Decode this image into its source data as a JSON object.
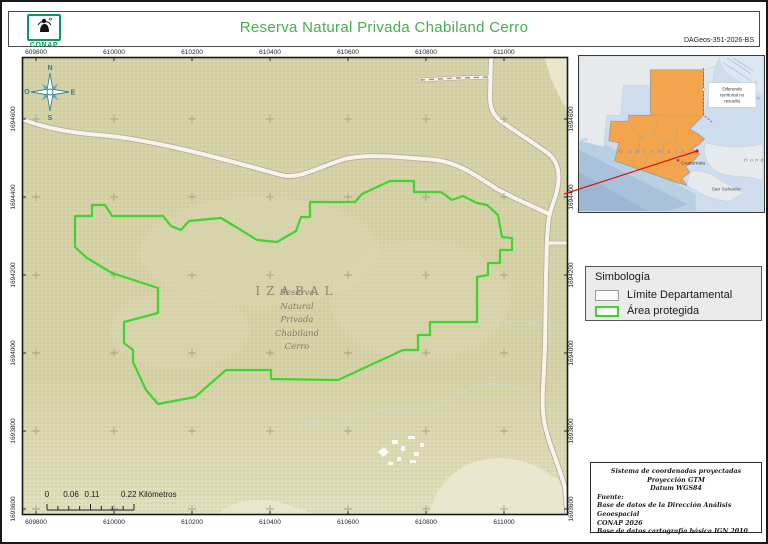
{
  "header": {
    "title": "Reserva Natural Privada Chabiland Cerro",
    "logo_text": "CONAP",
    "doc_code": "DAGeos-351-2026-BS"
  },
  "colors": {
    "title_green": "#44b14b",
    "logo_green": "#0a9a5e",
    "protected_area_green": "#3fd42e",
    "map_background": "#d6d3a8",
    "guatemala_orange": "#f2a54d",
    "sea_blue": "#cddded",
    "road_fill": "#f8f4ec",
    "red_connector": "#de1411",
    "compass_teal": "#35808f"
  },
  "map": {
    "x_labels": [
      "609800",
      "610000",
      "610200",
      "610400",
      "610600",
      "610800",
      "611000"
    ],
    "y_labels": [
      "1694600",
      "1694400",
      "1694200",
      "1694000",
      "1693800",
      "1693600"
    ],
    "x_px": [
      36,
      114,
      192,
      270,
      348,
      426,
      504
    ],
    "y_px": [
      119,
      197,
      275,
      353,
      431,
      509
    ],
    "department_label": "IZABAL",
    "reserve_label_lines": [
      "Reserva",
      "Natural",
      "Privada",
      "Chabiland",
      "Cerro"
    ],
    "compass": {
      "n": "N",
      "e": "E",
      "s": "S",
      "o": "O"
    },
    "geometry": {
      "area_points": "75,216 92,216 92,205 105,205 112,216 163,216 171,226 181,230 189,221 221,218 236,227 257,240 277,242 296,231 301,217 310,217 310,202 355,202 362,194 390,181 414,181 414,192 441,192 452,200 463,196 477,203 487,205 498,215 502,237 512,238 512,250 500,250 500,263 488,263 488,275 477,277 477,322 430,322 430,335 418,335 418,350 403,350 338,380 271,379 271,370 226,370 195,397 158,404 146,390 133,362 133,350 124,343 124,322 158,313 158,288 112,273 87,258 75,247",
      "road_main_d": "M8,113 C30,124 60,132 100,135 C150,139 220,158 281,175 C300,180 320,166 345,159 C370,153 410,158 436,160 C460,163 478,177 497,189 C517,200 533,206 549,214",
      "road_east_d": "M491,57 L490,96 C490,110 494,116 502,122 L545,151 C557,159 560,170 558,185 C556,200 551,205 549,218 C546,235 547,255 546,275 L545,345 C544,380 541,400 544,420 C548,444 559,464 565,488 L567,512",
      "road_stub_d": "M420,80 L458,78 L489,77",
      "road_branch_d": "M549,243 L568,243",
      "streams_d": "M297,428 C320,418 340,424 360,416 C385,406 398,412 420,410 C445,408 452,396 470,388 C490,380 510,384 528,392 M468,300 C485,310 495,325 515,322 C535,319 545,330 560,328",
      "clearings_d": "M430,515 C432,492 452,466 482,460 C516,453 543,468 558,480 C566,492 568,500 568,515 Z M218,515 C230,500 262,496 285,504 C298,509 310,512 318,515 Z M545,57 L568,57 L568,112 C558,95 548,75 545,57 Z",
      "buildings_d": "M378,452 l6,-5 5,5 -6,5 z M392,440 h6 v4 h-6 z M401,446 h4 v5 h-4 z M408,436 h7 v3 h-7 z M414,452 h5 v4 h-5 z M397,457 h4 v4 h-4 z M388,462 h5 v3 h-5 z M420,443 h4 v4 h-4 z M410,460 h6 v3 h-6 z",
      "red_connector_d": "M564,194 L697,151"
    }
  },
  "scalebar": {
    "zero": "0",
    "mid1": "0.06",
    "mid2": "0.11",
    "end": "0.22 Kilómetros"
  },
  "locator": {
    "country_label": "G u a t e m a l a",
    "city_label": "Guatemala",
    "san_salvador_label": "San Salvador",
    "honduras_label": "Honduras",
    "gulf_label_1": "G",
    "gulf_label_2": "Honda",
    "depth_label": "221",
    "note_line1": "Diferendo",
    "note_line2": "territorial no",
    "note_line3": "resuelto",
    "geometry": {
      "mexico_d": "M0,0 L143,0 L138,10 L130,24 L126,14 L72,14 L72,30 L45,30 L42,60 L28,60 L25,92 L0,86 Z",
      "belize_d": "M126,14 L138,10 L134,34 L129,50 L126,60 Z",
      "honduras_d": "M128,88 C145,92 162,94 186,89 L186,126 C165,120 150,124 138,116 C130,110 124,100 128,88 Z",
      "elsalvador_d": "M112,118 C120,114 132,118 140,124 C150,131 158,133 166,139 L152,147 C136,147 120,138 109,131 Z",
      "guatemala_d": "M72,14 L126,14 L126,60 L112,74 L119,78 L127,84 L121,90 L114,94 L122,99 L116,106 L108,112 L112,118 L104,124 L109,131 L98,128 L36,106 L40,88 L30,86 L32,66 L50,66 L50,60 L72,60 Z",
      "dept_borders_d": "M72,60 L125,60 M50,66 L62,82 L60,98 M62,82 L76,78 L80,64 M76,78 L86,88 L84,104 M86,88 L98,84 L100,72 M98,84 L104,95 M58,98 L54,106 M70,100 L66,112 M80,106 L78,116 M92,102 L90,114 M104,95 L100,106",
      "belize_border_d": "M126,12 L126,60 L136,68",
      "pacific_band1_d": "M0,75 L118,140 L118,157 L0,157 Z",
      "pacific_band2_d": "M0,95 L110,150 L90,157 L0,157 Z",
      "pacific_band3_d": "M0,118 L70,157 L0,157 Z",
      "caribbean_d": "M140,0 L186,0 L186,40 L150,18 Z",
      "caribbean_stripes_d": "M150,2 l24,16 M146,7 l28,18 M156,2 l20,13 M128,20 h8 M127,30 h8 M127,40 h7"
    }
  },
  "legend": {
    "title": "Simbología",
    "items": [
      {
        "label": "Límite Departamental"
      },
      {
        "label": "Área protegida"
      }
    ]
  },
  "source_box": {
    "line1": "Sistema de coordenadas proyectadas",
    "line2": "Proyección GTM",
    "line3": "Datum WGS84",
    "line4": "Fuente:",
    "line5": "Base de datos de la Dirección Análisis Geoespacial",
    "line6": "CONAP 2026",
    "line7": "Base de datos cartografía básica IGN 2010"
  }
}
